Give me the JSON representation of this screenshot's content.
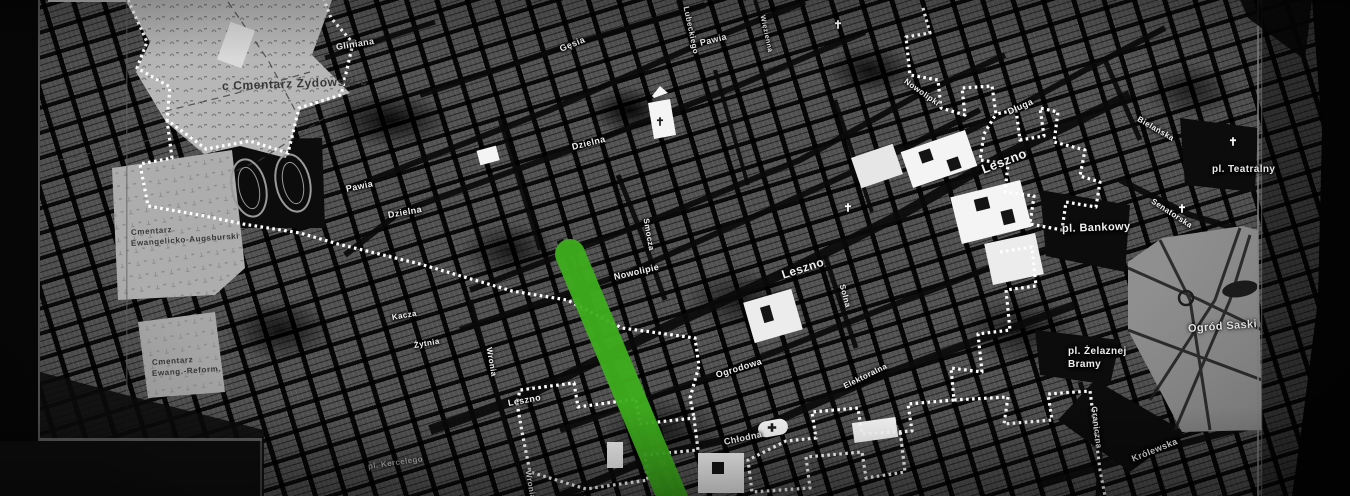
{
  "map": {
    "description": "Black-and-white historical street map of Warsaw with dotted ghetto boundary and highlighted route",
    "colors": {
      "route_green": "#3eae1d",
      "boundary_white": "#ffffff",
      "block_gray": "#565656",
      "light_area": "#b7b7b7",
      "park_gray": "#8f8f8f",
      "street_black": "#0a0a0a"
    },
    "route": {
      "x1": 570,
      "y1": 254,
      "x2": 676,
      "y2": 506,
      "width": 30
    },
    "boundary_segments": [
      "128,0 147,42 137,68 170,87 167,120 206,149 250,141 288,153 299,108 341,95 353,43 331,18 324,0",
      "167,120 172,158 140,164 148,206 205,216 243,224 300,233 338,244 420,264 512,291 567,300 622,328 695,338 699,366 690,398 694,418",
      "923,8 930,33 906,37 910,75 938,80 941,108 965,115 962,88 992,86 996,114 1016,110 1020,140 1044,136 1040,108 1058,112 1054,142 1085,150 1080,176 1100,182 1096,207 1066,202 1062,230 1030,224 1034,196 1005,192 1008,164 980,160 984,134 996,114",
      "1000,252 1032,247 1036,286 1006,290 1010,330 978,334 982,372 951,368 954,400 1008,397 1004,424 1052,420 1048,394 1090,391 1095,430 1100,470 1105,496",
      "954,400 908,404 912,431 862,434 858,408 812,412 816,438 786,441 748,460 752,492 810,488 806,457 862,452 866,478 905,472 900,430",
      "517,403 522,432 530,472 586,489 648,480 645,455 698,450 694,418 640,424 636,399 578,407 574,383 520,390 517,403"
    ],
    "labels": {
      "streets": [
        {
          "t": "Gliniana",
          "x": 336,
          "y": 42,
          "r": -9,
          "s": 9
        },
        {
          "t": "Gęsia",
          "x": 560,
          "y": 44,
          "r": -22,
          "s": 9
        },
        {
          "t": "Lubeckiego",
          "x": 686,
          "y": 2,
          "r": 78,
          "s": 8
        },
        {
          "t": "Pawia",
          "x": 700,
          "y": 38,
          "r": -14,
          "s": 9
        },
        {
          "t": "Więzienna",
          "x": 762,
          "y": 12,
          "r": 78,
          "s": 7
        },
        {
          "t": "Dzielna",
          "x": 572,
          "y": 142,
          "r": -14,
          "s": 9
        },
        {
          "t": "Pawia",
          "x": 346,
          "y": 184,
          "r": -12,
          "s": 9
        },
        {
          "t": "Dzielna",
          "x": 388,
          "y": 210,
          "r": -10,
          "s": 9
        },
        {
          "t": "Nowolipki",
          "x": 905,
          "y": 76,
          "r": 35,
          "s": 8
        },
        {
          "t": "Smocza",
          "x": 646,
          "y": 214,
          "r": 80,
          "s": 8
        },
        {
          "t": "Nowolipie",
          "x": 614,
          "y": 272,
          "r": -13,
          "s": 9
        },
        {
          "t": "Leszno",
          "x": 982,
          "y": 162,
          "r": -21,
          "s": 13
        },
        {
          "t": "Leszno",
          "x": 782,
          "y": 268,
          "r": -18,
          "s": 12
        },
        {
          "t": "Leszno",
          "x": 508,
          "y": 398,
          "r": -10,
          "s": 9
        },
        {
          "t": "Ogrodowa",
          "x": 716,
          "y": 370,
          "r": -17,
          "s": 9
        },
        {
          "t": "Chłodna",
          "x": 724,
          "y": 437,
          "r": -12,
          "s": 9
        },
        {
          "t": "Solna",
          "x": 842,
          "y": 280,
          "r": 75,
          "s": 8
        },
        {
          "t": "Elektoralna",
          "x": 844,
          "y": 382,
          "r": -26,
          "s": 8
        },
        {
          "t": "Długa",
          "x": 1008,
          "y": 107,
          "r": -24,
          "s": 9
        },
        {
          "t": "Bielańska",
          "x": 1138,
          "y": 114,
          "r": 30,
          "s": 8
        },
        {
          "t": "Senatorska",
          "x": 1152,
          "y": 196,
          "r": 33,
          "s": 8
        },
        {
          "t": "Graniczna",
          "x": 1094,
          "y": 402,
          "r": 83,
          "s": 8
        },
        {
          "t": "Królewska",
          "x": 1132,
          "y": 454,
          "r": -22,
          "s": 9
        },
        {
          "t": "Wronia",
          "x": 489,
          "y": 343,
          "r": 80,
          "s": 8
        },
        {
          "t": "Wronia",
          "x": 528,
          "y": 466,
          "r": 80,
          "s": 8
        },
        {
          "t": "Kacza",
          "x": 392,
          "y": 313,
          "r": -10,
          "s": 8
        },
        {
          "t": "Żytnia",
          "x": 414,
          "y": 341,
          "r": -10,
          "s": 8
        },
        {
          "t": "pl. Kercelego",
          "x": 368,
          "y": 462,
          "r": -8,
          "s": 8,
          "c": "dim"
        }
      ],
      "places": [
        {
          "t": "pl. Teatralny",
          "x": 1212,
          "y": 164,
          "r": 0,
          "s": 10
        },
        {
          "t": "pl. Bankowy",
          "x": 1062,
          "y": 223,
          "r": -2,
          "s": 11
        },
        {
          "t": "pl. Żelaznej",
          "x": 1068,
          "y": 346,
          "r": 0,
          "s": 10
        },
        {
          "t": "Bramy",
          "x": 1068,
          "y": 359,
          "r": 0,
          "s": 10
        },
        {
          "t": "Ogród Saski",
          "x": 1188,
          "y": 323,
          "r": -4,
          "s": 11,
          "c": "glow"
        }
      ],
      "cemeteries": [
        {
          "t": "c Cmentarz Żydowski c",
          "x": 222,
          "y": 79,
          "r": -2,
          "s": 12
        },
        {
          "t": "Cmentarz",
          "x": 131,
          "y": 228,
          "r": -4,
          "s": 8
        },
        {
          "t": "Ewangelicko-Augsburski",
          "x": 131,
          "y": 239,
          "r": -4,
          "s": 8
        },
        {
          "t": "Cmentarz",
          "x": 152,
          "y": 358,
          "r": -4,
          "s": 8
        },
        {
          "t": "Ewang.-Reform.",
          "x": 152,
          "y": 369,
          "r": -4,
          "s": 8
        }
      ]
    },
    "church_icons": [
      {
        "glyph": "✝",
        "x": 838,
        "y": 25
      },
      {
        "glyph": "✝",
        "x": 848,
        "y": 208
      },
      {
        "glyph": "✝",
        "x": 1182,
        "y": 209
      },
      {
        "glyph": "✝",
        "x": 1233,
        "y": 142
      },
      {
        "glyph": "✝",
        "x": 660,
        "y": 122,
        "dark": true
      },
      {
        "glyph": "✚",
        "x": 772,
        "y": 428,
        "dark": true
      }
    ]
  }
}
